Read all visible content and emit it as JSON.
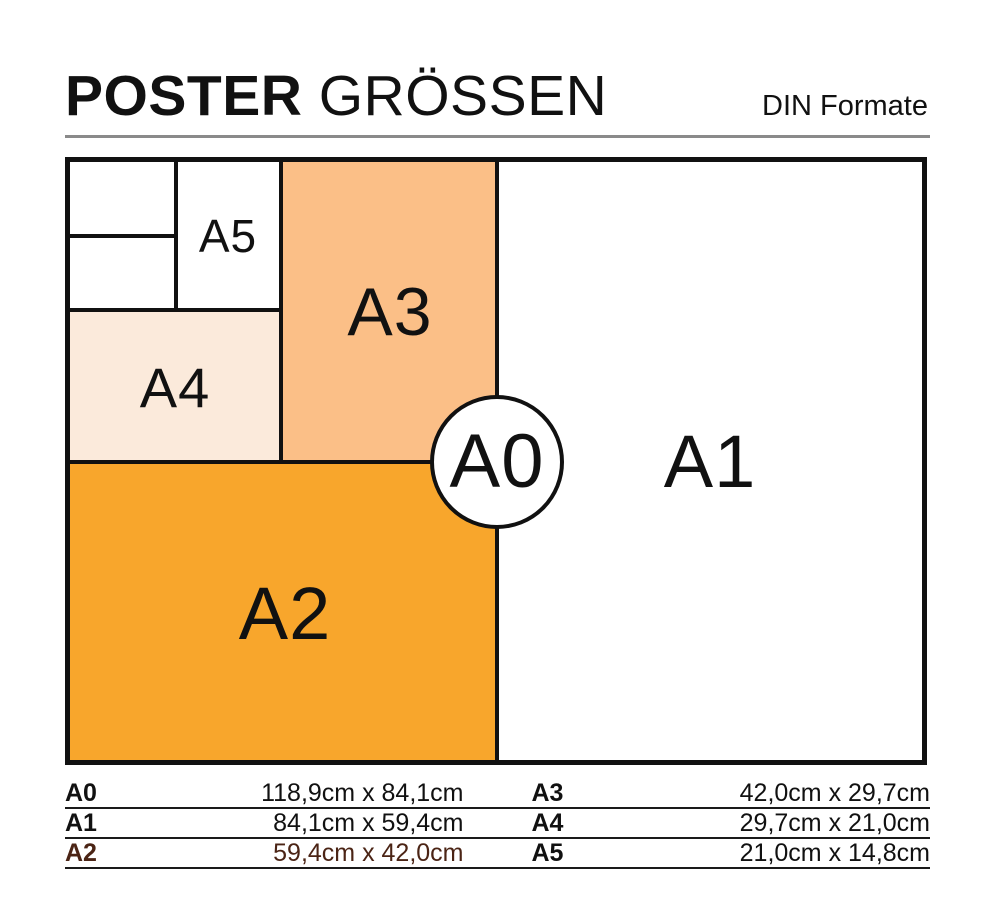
{
  "header": {
    "title_bold": "POSTER",
    "title_regular": "GRÖSSEN",
    "subtitle": "DIN Formate"
  },
  "diagram": {
    "a0": "A0",
    "a1": "A1",
    "a2": "A2",
    "a3": "A3",
    "a4": "A4",
    "a5": "A5"
  },
  "table": {
    "rows": [
      {
        "left_label": "A0",
        "left_value": "118,9cm x 84,1cm",
        "right_label": "A3",
        "right_value": "42,0cm x 29,7cm"
      },
      {
        "left_label": "A1",
        "left_value": "84,1cm x 59,4cm",
        "right_label": "A4",
        "right_value": "29,7cm x 21,0cm"
      },
      {
        "left_label": "A2",
        "left_value": "59,4cm x 42,0cm",
        "right_label": "A5",
        "right_value": "21,0cm x 14,8cm"
      }
    ]
  },
  "colors": {
    "ink": "#111111",
    "a2_fill": "#F8A62C",
    "a3_fill": "#FBBF87",
    "a4_fill": "#FBEADB",
    "divider_gray": "#8A8A8A",
    "table_rule": "#1A1A1A",
    "a2_row_text": "#4B2415"
  }
}
